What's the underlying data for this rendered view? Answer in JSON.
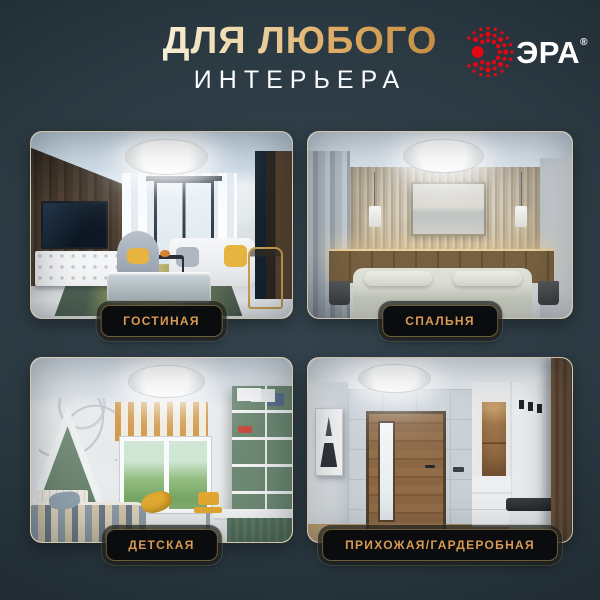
{
  "page": {
    "background_color": "#2b3942",
    "accent_gold": "#d2a05a",
    "badge_background": "#0b0c0d",
    "badge_text_color": "#d79a55"
  },
  "header": {
    "title_line1": "ДЛЯ ЛЮБОГО",
    "title_line2": "ИНТЕРЬЕРА",
    "brand": {
      "name": "ЭРА",
      "registered_mark": "®",
      "icon": "era-dotted-sunburst-logo-icon",
      "logo_color": "#e30613"
    }
  },
  "rooms": [
    {
      "label": "ГОСТИНАЯ"
    },
    {
      "label": "СПАЛЬНЯ"
    },
    {
      "label": "ДЕТСКАЯ"
    },
    {
      "label": "ПРИХОЖАЯ/ГАРДЕРОБНАЯ"
    }
  ]
}
